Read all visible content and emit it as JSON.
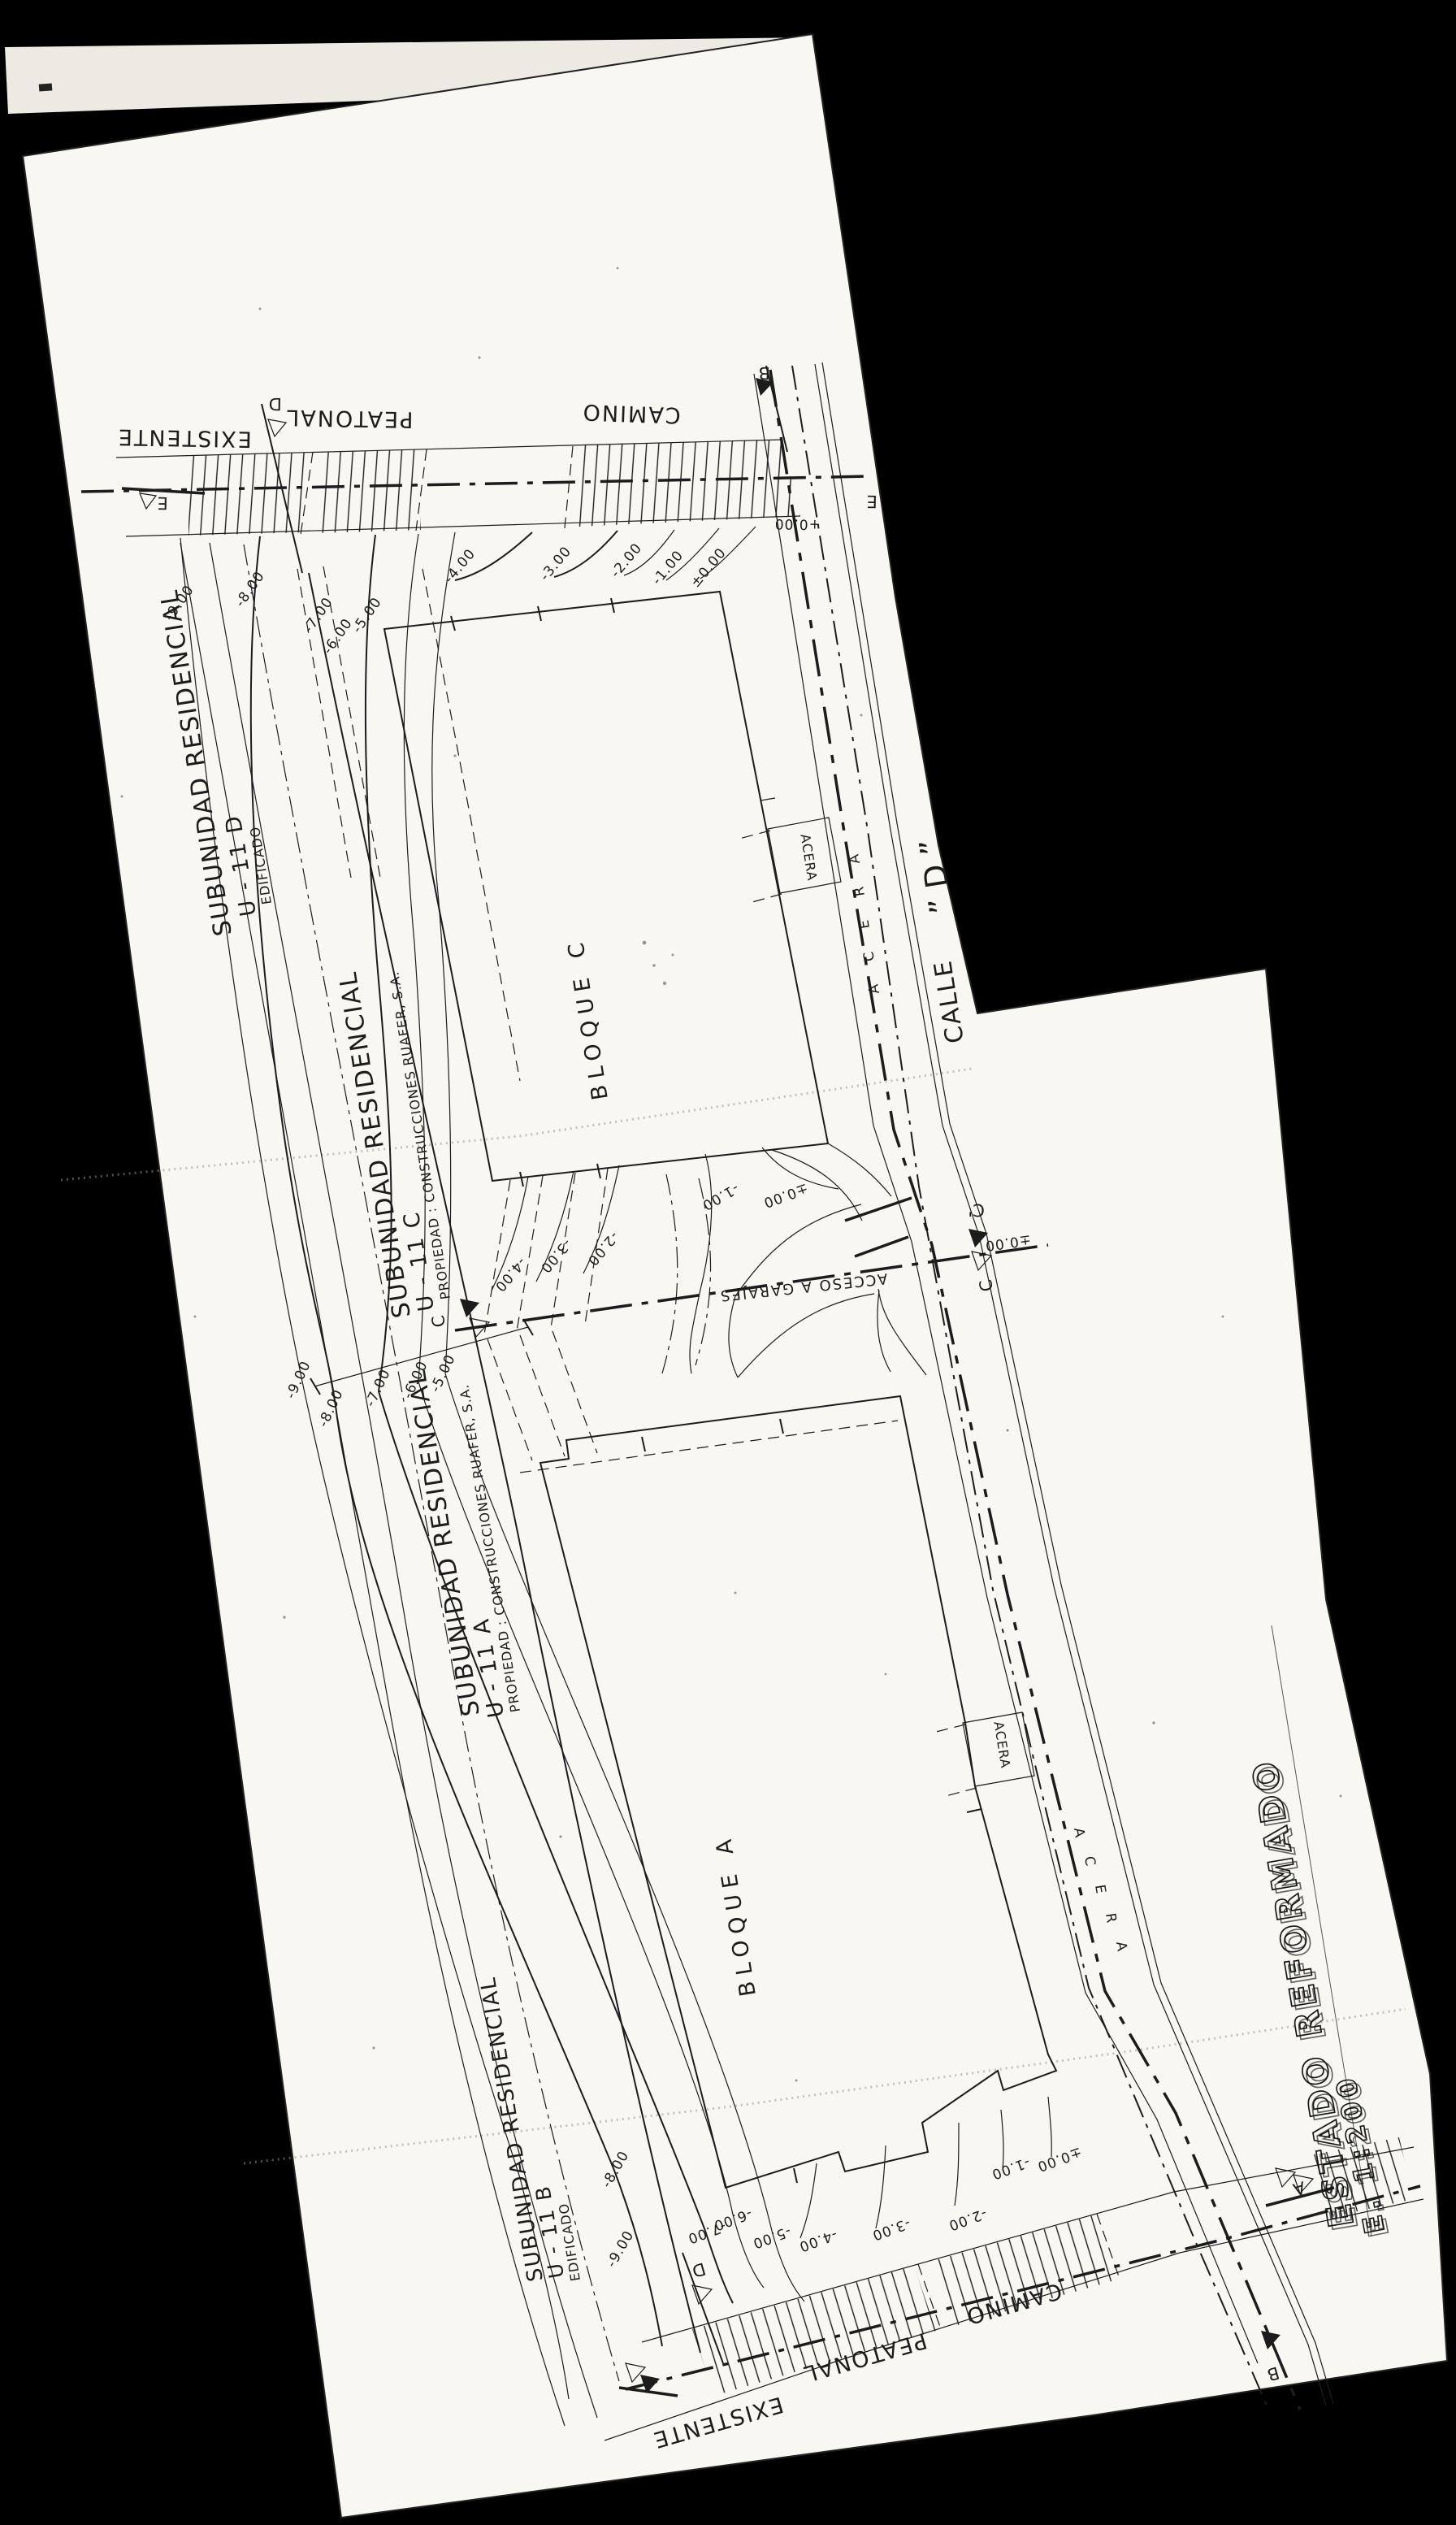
{
  "colors": {
    "background": "#000000",
    "paper": "#f8f7f2",
    "paper_back": "#eceae3",
    "ink": "#1c1c1c"
  },
  "plan": {
    "subunits": {
      "d": {
        "title": "SUBUNIDAD  RESIDENCIAL",
        "unit": "U - 11   D",
        "note": "EDIFICADO"
      },
      "c": {
        "title": "SUBUNIDAD  RESIDENCIAL",
        "unit": "U - 11   C",
        "note": "PROPIEDAD : CONSTRUCCIONES  RUAFER, S.A."
      },
      "a": {
        "title": "SUBUNIDAD  RESIDENCIAL",
        "unit": "U - 11   A",
        "note": "PROPIEDAD : CONSTRUCCIONES  RUAFER, S.A."
      },
      "b": {
        "title": "SUBUNIDAD  RESIDENCIAL",
        "unit": "U - 11   B",
        "note": "EDIFICADO"
      }
    },
    "buildings": {
      "c": "BLOQUE  C",
      "a": "BLOQUE  A"
    },
    "street": {
      "name": "CALLE",
      "d_quoted": "” D ”",
      "sidewalk": "ACERA",
      "sidewalk_letters": [
        "A",
        "C",
        "E",
        "R",
        "A"
      ]
    },
    "roads": {
      "top": [
        "EXISTENTE",
        "PEATONAL",
        "CAMINO"
      ],
      "bottom": [
        "CAMINO",
        "PEATONAL",
        "EXISTENTE"
      ]
    },
    "access": "ACCESO  A  GARAJES",
    "levels": {
      "top": [
        "-9.00",
        "-8.00",
        "-7.00",
        "-6.00",
        "-5.00",
        "-4.00",
        "-3.00",
        "-2.00",
        "-1.00",
        "±0.00"
      ],
      "mid_left": [
        "-9.00",
        "-8.00",
        "-7.00",
        "-6.00",
        "-5.00"
      ],
      "mid": [
        "-4.00",
        "-3.00",
        "-2.00",
        "-1.00",
        "±0.00"
      ],
      "bottom": [
        "-7.00",
        "-6.00",
        "-5.00",
        "-4.00",
        "-3.00",
        "-2.00",
        "-1.00",
        "±0.00"
      ],
      "bottom_left": [
        "-8.00",
        "-9.00"
      ],
      "street_top": "+0.00",
      "street_mid": "±0.00"
    },
    "markers": {
      "a": "A",
      "b": "B",
      "c": "C",
      "c_prime": "C'",
      "d": "D",
      "e": "E"
    },
    "title": {
      "line1": "ESTADO  REFORMADO",
      "line2": "E.  1:200"
    }
  }
}
